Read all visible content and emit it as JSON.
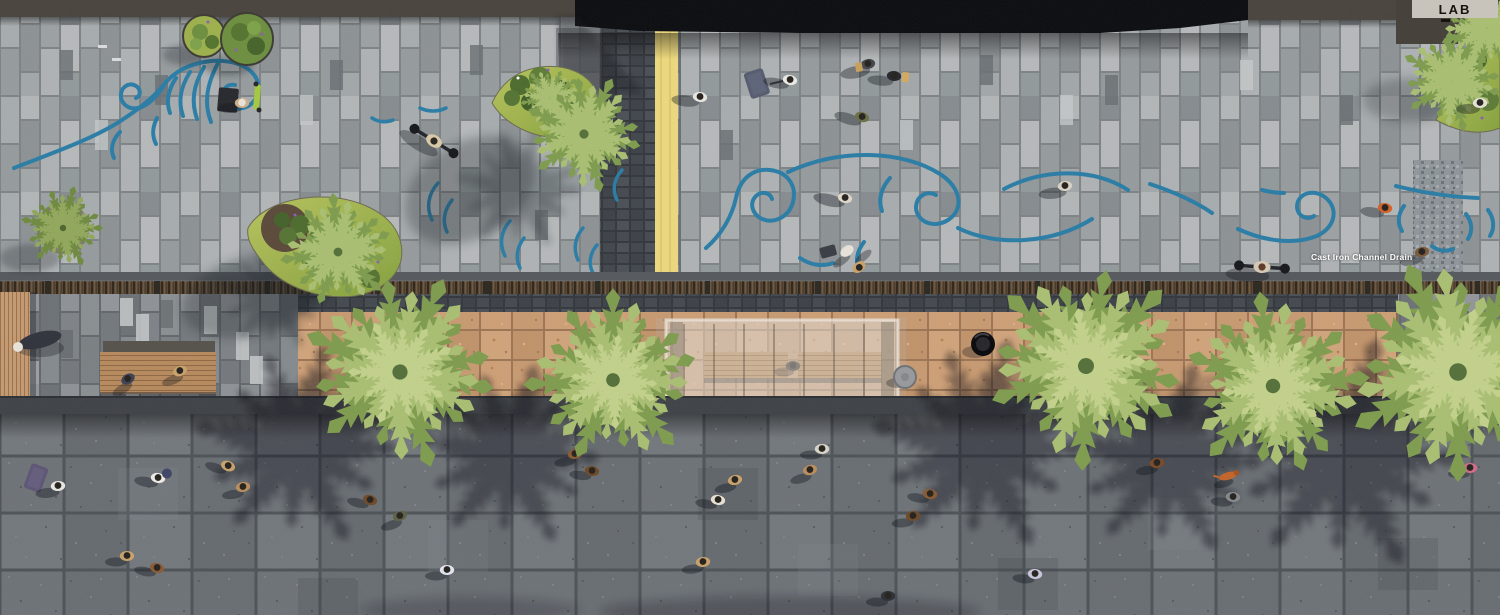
{
  "logo": {
    "text": "LAB"
  },
  "annotations": {
    "drain_label": "Cast Iron Channel Drain"
  },
  "colors": {
    "wave_mural_blue": "#2a7da6",
    "tactile_strip_yellow": "#ecd87e",
    "transit_band_tan": "#c79a71",
    "promenade_paving_gray": "#9aa0a3",
    "roadway_granite_gray": "#6d7277",
    "planting_green": "#9db04c",
    "timber_wood": "#c49a71",
    "building_roof_black": "#0c0d10",
    "drain_grate_brown": "#584633"
  }
}
